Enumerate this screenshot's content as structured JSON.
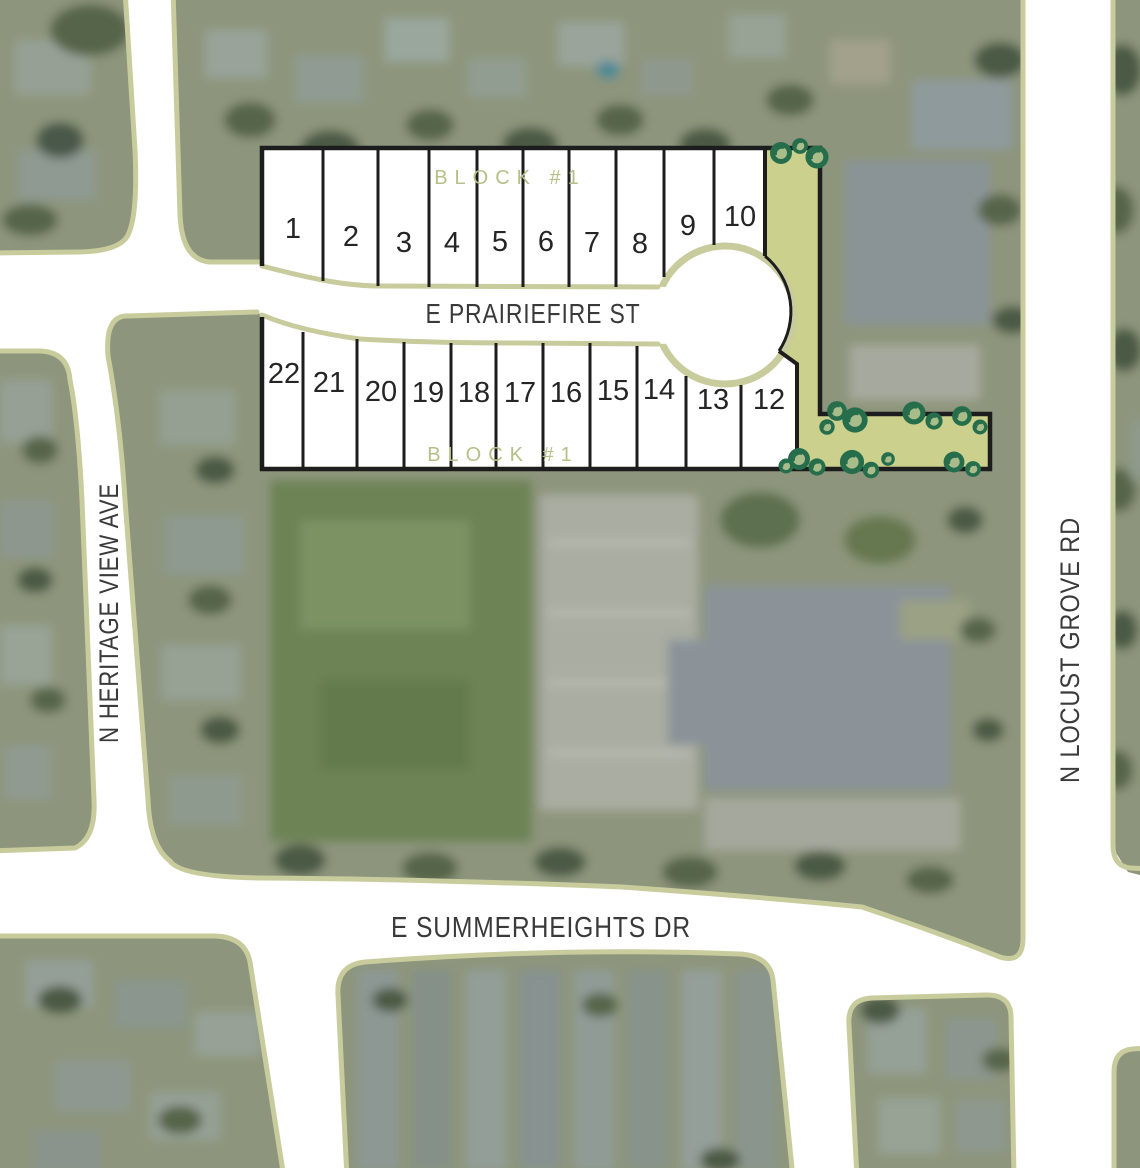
{
  "streets": {
    "prairiefire": "E PRAIRIEFIRE ST",
    "summerheights": "E SUMMERHEIGHTS DR",
    "heritage_view": "N HERITAGE VIEW AVE",
    "locust_grove": "N LOCUST GROVE RD"
  },
  "plat": {
    "block_label_top": "BLOCK #1",
    "block_label_bottom": "BLOCK #1",
    "top_row_lots": [
      "1",
      "2",
      "3",
      "4",
      "5",
      "6",
      "7",
      "8",
      "9",
      "10"
    ],
    "bottom_row_lots": [
      "22",
      "21",
      "20",
      "19",
      "18",
      "17",
      "16",
      "15",
      "14",
      "13",
      "12"
    ]
  },
  "colors": {
    "street_edge": "#c8cc9d",
    "common_area": "#cbd08d",
    "tree_dark": "#266e4b",
    "tree_light": "#a9bd8a",
    "plat_line": "#1d1d1d",
    "block_label": "#b7bf88",
    "street_label": "#3a3a3a",
    "lot_number": "#252525",
    "aerial_base": "#8d957b"
  }
}
